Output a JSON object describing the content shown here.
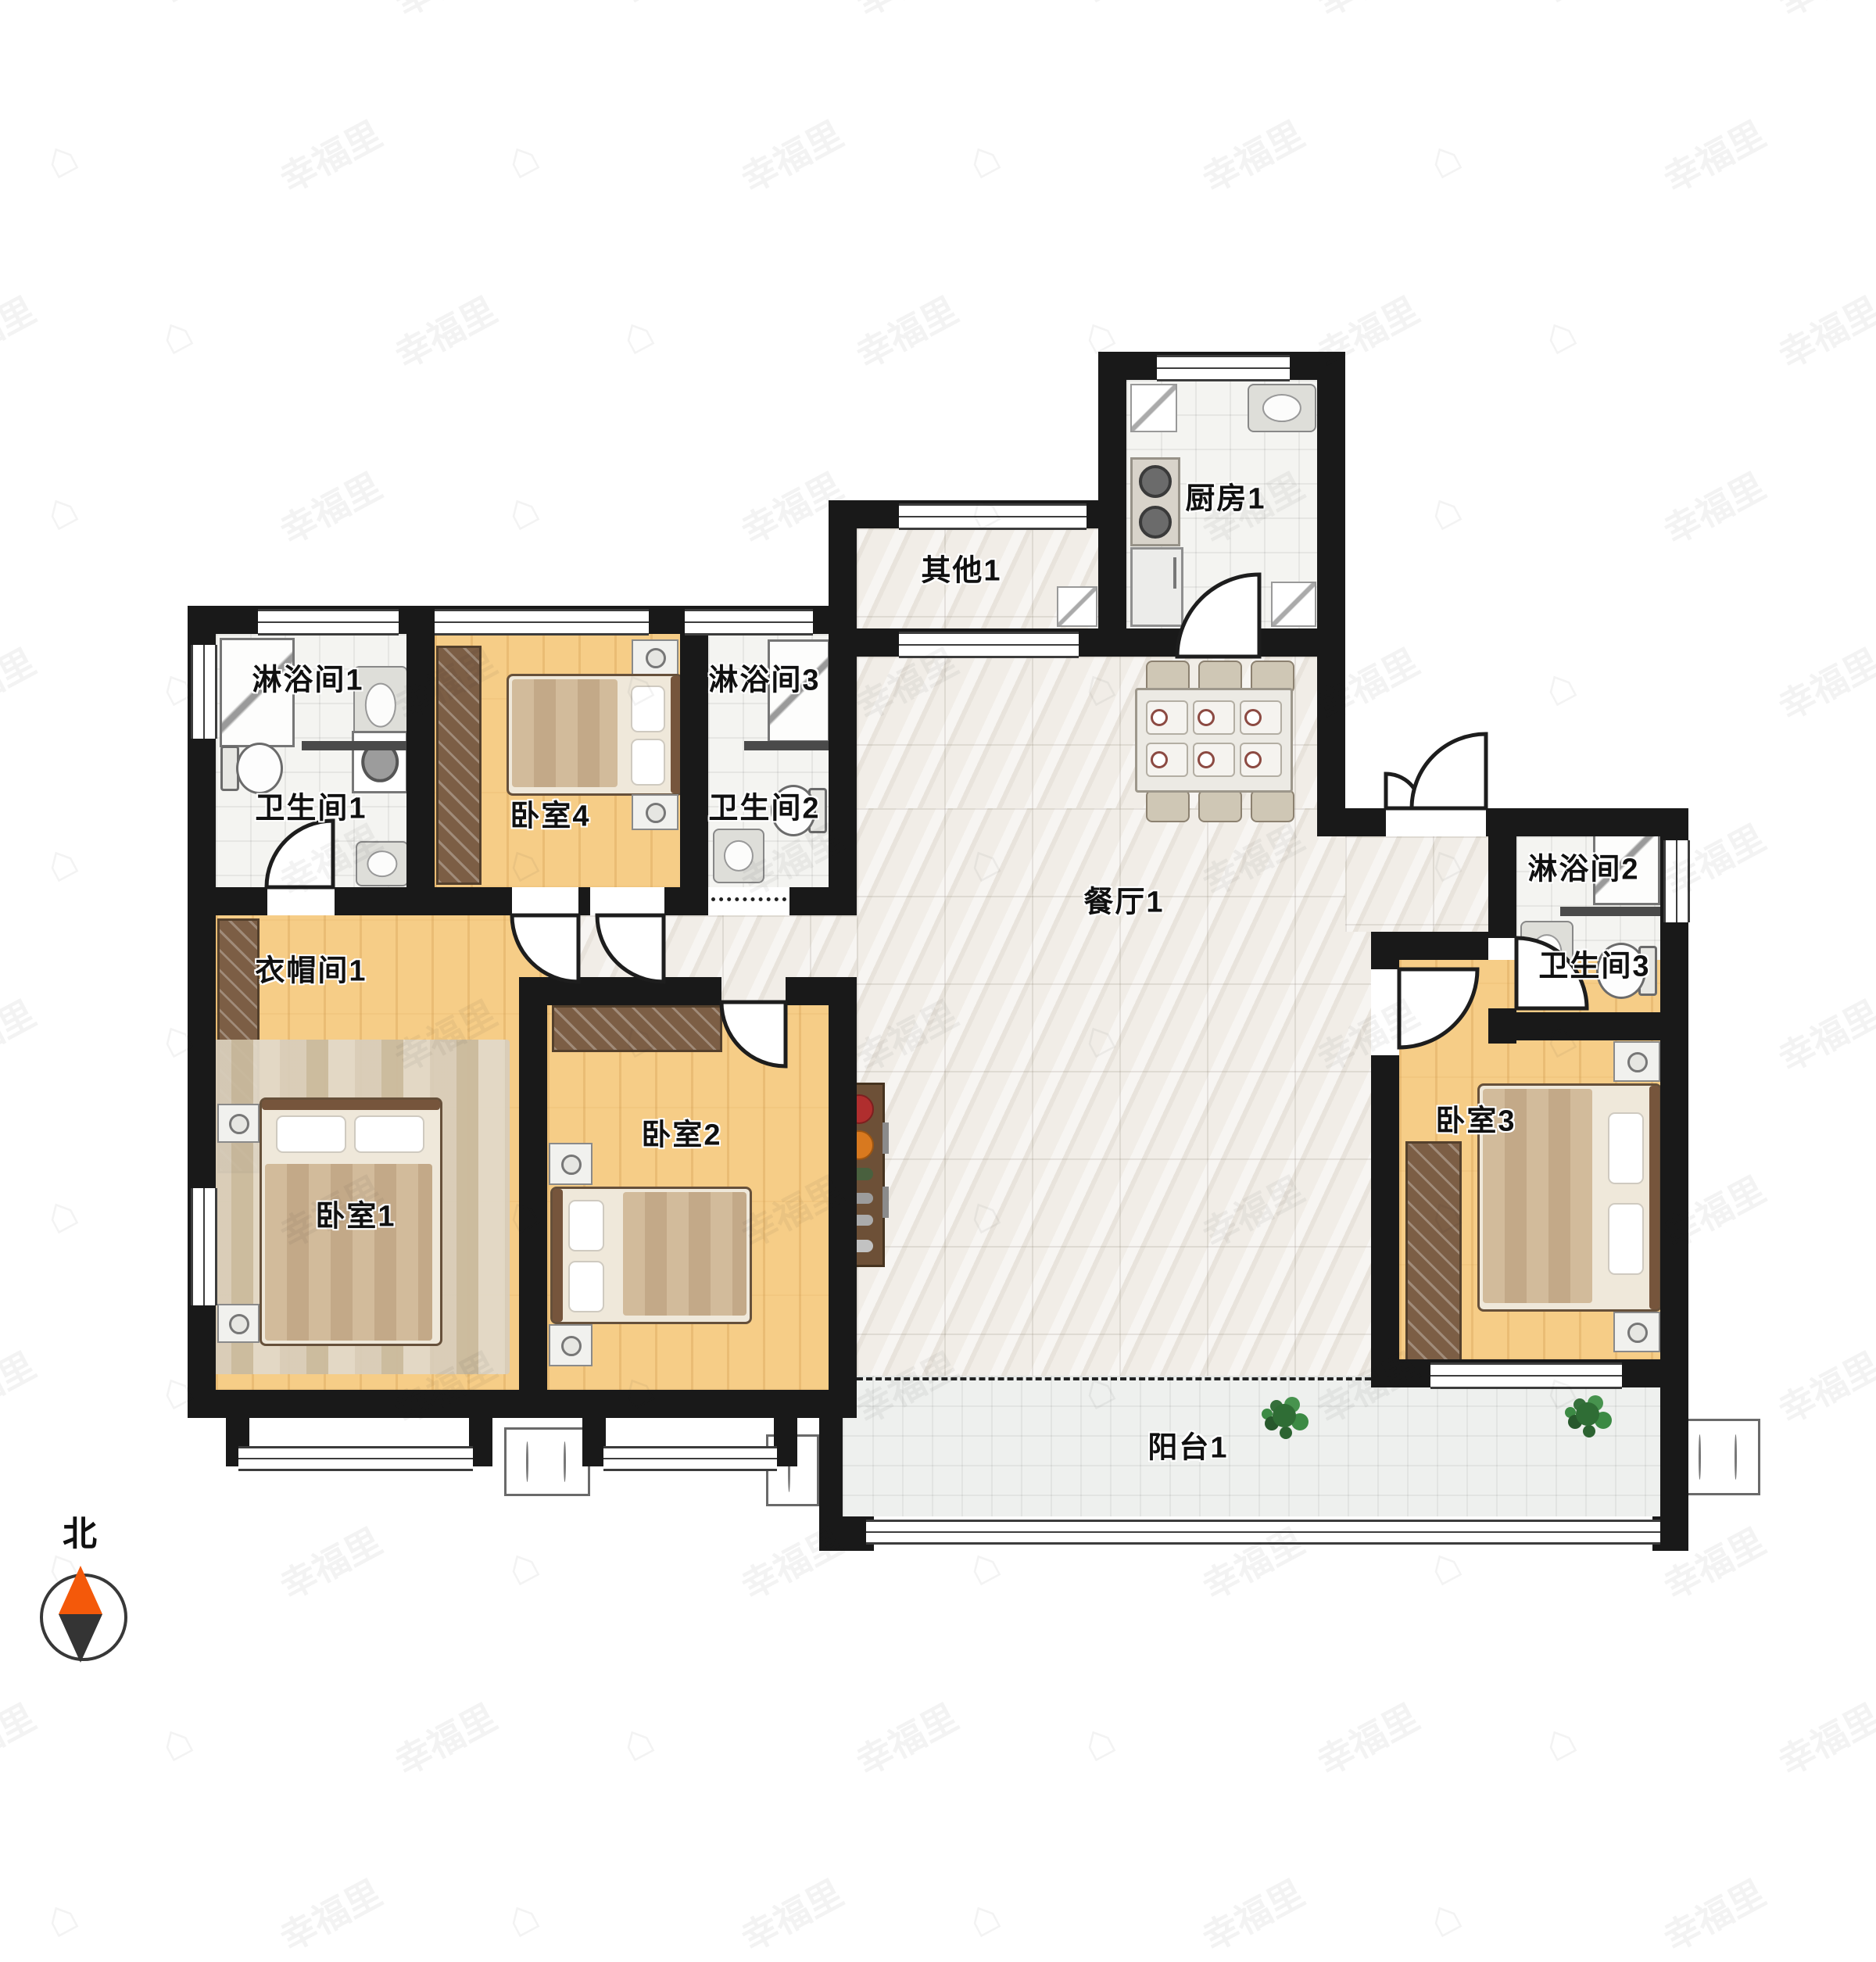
{
  "compass": {
    "label": "北"
  },
  "watermark": {
    "text": "幸福里",
    "glyph": "⌂"
  },
  "colors": {
    "wall": "#191919",
    "wood_floor": "#f6cd87",
    "tile_floor": "#f4f4f1",
    "marble_floor": "#f1ede7",
    "furniture_wood": "#7c5e45",
    "compass_needle": "#f4590a"
  },
  "rooms": [
    {
      "label": "淋浴间1"
    },
    {
      "label": "卫生间1"
    },
    {
      "label": "卧室4"
    },
    {
      "label": "淋浴间3"
    },
    {
      "label": "卫生间2"
    },
    {
      "label": "其他1"
    },
    {
      "label": "厨房1"
    },
    {
      "label": "餐厅1"
    },
    {
      "label": "衣帽间1"
    },
    {
      "label": "卧室1"
    },
    {
      "label": "卧室2"
    },
    {
      "label": "淋浴间2"
    },
    {
      "label": "卫生间3"
    },
    {
      "label": "卧室3"
    },
    {
      "label": "阳台1"
    }
  ]
}
